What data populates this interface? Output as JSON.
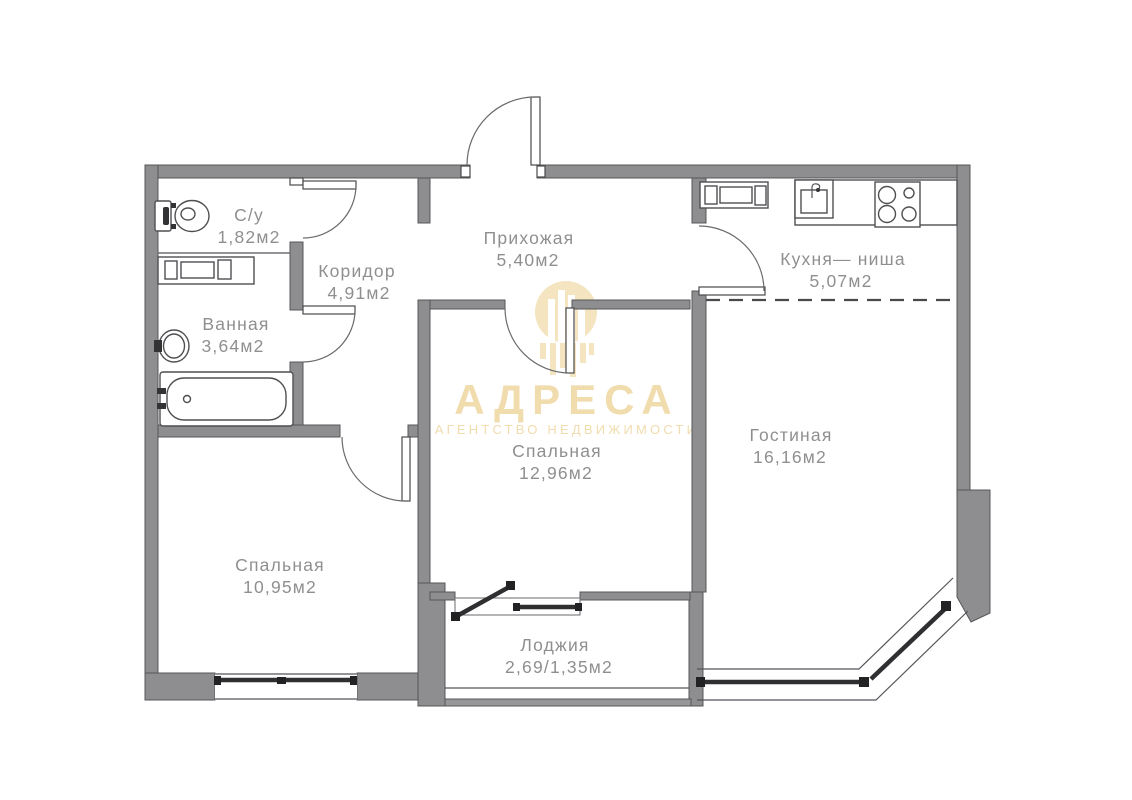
{
  "plan": {
    "rooms": [
      {
        "name": "С/у",
        "area": "1,82м2"
      },
      {
        "name": "Ванная",
        "area": "3,64м2"
      },
      {
        "name": "Коридор",
        "area": "4,91м2"
      },
      {
        "name": "Прихожая",
        "area": "5,40м2"
      },
      {
        "name": "Кухня— ниша",
        "area": "5,07м2"
      },
      {
        "name": "Гостиная",
        "area": "16,16м2"
      },
      {
        "name": "Спальная",
        "area": "12,96м2"
      },
      {
        "name": "Спальная",
        "area": "10,95м2"
      },
      {
        "name": "Лоджия",
        "area": "2,69/1,35м2"
      }
    ],
    "fixtures": [
      "toilet",
      "washing-machine",
      "bathroom-sink",
      "bathtub",
      "kitchen-cabinet",
      "kitchen-sink",
      "stove"
    ],
    "colors": {
      "wall": "#8e8e90",
      "wall_outline": "#57575a",
      "label_text": "#8f8f8f",
      "window_glass": "#2f2f31",
      "watermark_gold": "#f1dcae",
      "background": "#ffffff"
    }
  },
  "watermark": {
    "title": "АДРЕСА",
    "subtitle": "АГЕНТСТВО НЕДВИЖИМОСТИ"
  }
}
